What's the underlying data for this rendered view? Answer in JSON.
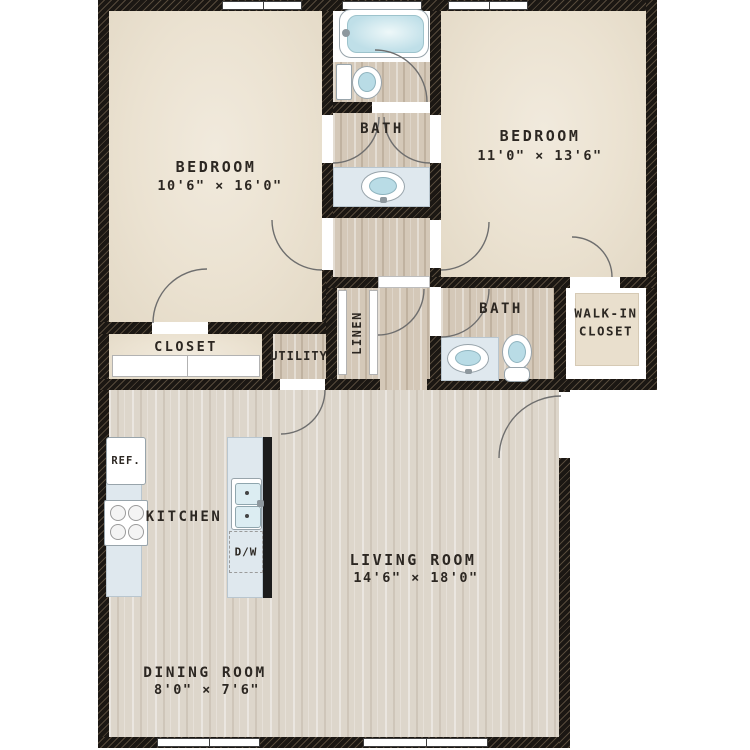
{
  "floorplan": {
    "rooms": {
      "bedroom1": {
        "label": "BEDROOM",
        "dims": "10'6\" × 16'0\""
      },
      "bedroom2": {
        "label": "BEDROOM",
        "dims": "11'0\" × 13'6\""
      },
      "living_room": {
        "label": "LIVING ROOM",
        "dims": "14'6\" × 18'0\""
      },
      "dining_room": {
        "label": "DINING ROOM",
        "dims": "8'0\" × 7'6\""
      },
      "kitchen": {
        "label": "KITCHEN"
      },
      "bath1": {
        "label": "BATH"
      },
      "bath2": {
        "label": "BATH"
      },
      "closet": {
        "label": "CLOSET"
      },
      "utility": {
        "label": "UTILITY"
      },
      "linen": {
        "label": "LINEN"
      },
      "walk_in_closet": {
        "line1": "WALK-IN",
        "line2": "CLOSET"
      }
    },
    "appliances": {
      "refrigerator": "REF.",
      "dishwasher": "D/W"
    },
    "colors": {
      "wall": "#1b1713",
      "bedroom_floor": "#ebe2d1",
      "wood_floor": "#d4c8b8",
      "living_floor": "#ddd6cb",
      "counter": "#dfe8ee",
      "water": "#bfdfe8"
    }
  }
}
